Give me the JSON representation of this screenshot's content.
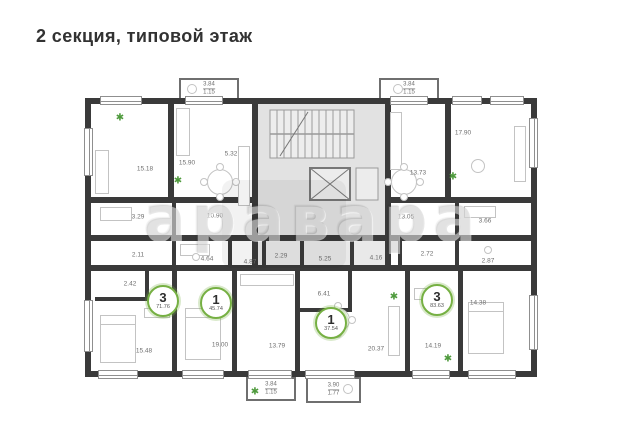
{
  "title": "2 секция, типовой этаж",
  "watermark": "аравара",
  "icons": {
    "plant": "✱"
  },
  "colors": {
    "wall": "#3a3a3a",
    "accent_green": "#76b043",
    "common_area": "#e2e2e2",
    "label_gray": "#6f6f6f"
  },
  "apartments": [
    {
      "rooms_count": "3",
      "total_area": "71.76",
      "x": 163,
      "y": 301
    },
    {
      "rooms_count": "1",
      "total_area": "45.74",
      "x": 216,
      "y": 303
    },
    {
      "rooms_count": "1",
      "total_area": "37.54",
      "x": 331,
      "y": 323
    },
    {
      "rooms_count": "3",
      "total_area": "83.63",
      "x": 437,
      "y": 300
    }
  ],
  "area_labels": [
    {
      "t": "15.18",
      "x": 145,
      "y": 169
    },
    {
      "t": "15.90",
      "x": 187,
      "y": 163
    },
    {
      "t": "5.32",
      "x": 231,
      "y": 154
    },
    {
      "t": "3.29",
      "x": 138,
      "y": 217
    },
    {
      "t": "10.90",
      "x": 215,
      "y": 216
    },
    {
      "t": "2.11",
      "x": 138,
      "y": 255
    },
    {
      "t": "4.64",
      "x": 207,
      "y": 259
    },
    {
      "t": "2.42",
      "x": 130,
      "y": 284
    },
    {
      "t": "15.48",
      "x": 144,
      "y": 351
    },
    {
      "t": "19.00",
      "x": 220,
      "y": 345
    },
    {
      "t": "13.79",
      "x": 277,
      "y": 346
    },
    {
      "t": "4.87",
      "x": 250,
      "y": 262
    },
    {
      "t": "2.29",
      "x": 281,
      "y": 256
    },
    {
      "t": "5.25",
      "x": 325,
      "y": 259
    },
    {
      "t": "4.16",
      "x": 376,
      "y": 258
    },
    {
      "t": "6.41",
      "x": 324,
      "y": 294
    },
    {
      "t": "20.37",
      "x": 376,
      "y": 349
    },
    {
      "t": "13.73",
      "x": 418,
      "y": 173
    },
    {
      "t": "17.90",
      "x": 463,
      "y": 133
    },
    {
      "t": "13.05",
      "x": 406,
      "y": 217
    },
    {
      "t": "3.66",
      "x": 485,
      "y": 221
    },
    {
      "t": "2.72",
      "x": 427,
      "y": 254
    },
    {
      "t": "2.87",
      "x": 488,
      "y": 261
    },
    {
      "t": "14.19",
      "x": 433,
      "y": 346
    },
    {
      "t": "14.38",
      "x": 478,
      "y": 303
    }
  ],
  "balconies": [
    {
      "a1": "3.84",
      "a2": "1.15",
      "x": 179,
      "y": 78,
      "w": 60,
      "h": 22
    },
    {
      "a1": "3.84",
      "a2": "1.15",
      "x": 379,
      "y": 78,
      "w": 60,
      "h": 22
    },
    {
      "a1": "3.84",
      "a2": "1.15",
      "x": 246,
      "y": 377,
      "w": 50,
      "h": 24
    },
    {
      "a1": "3.90",
      "a2": "1.77",
      "x": 306,
      "y": 377,
      "w": 55,
      "h": 26
    }
  ],
  "plants": [
    {
      "x": 120,
      "y": 118
    },
    {
      "x": 178,
      "y": 181
    },
    {
      "x": 453,
      "y": 177
    },
    {
      "x": 394,
      "y": 297
    },
    {
      "x": 448,
      "y": 359
    },
    {
      "x": 255,
      "y": 392
    }
  ]
}
